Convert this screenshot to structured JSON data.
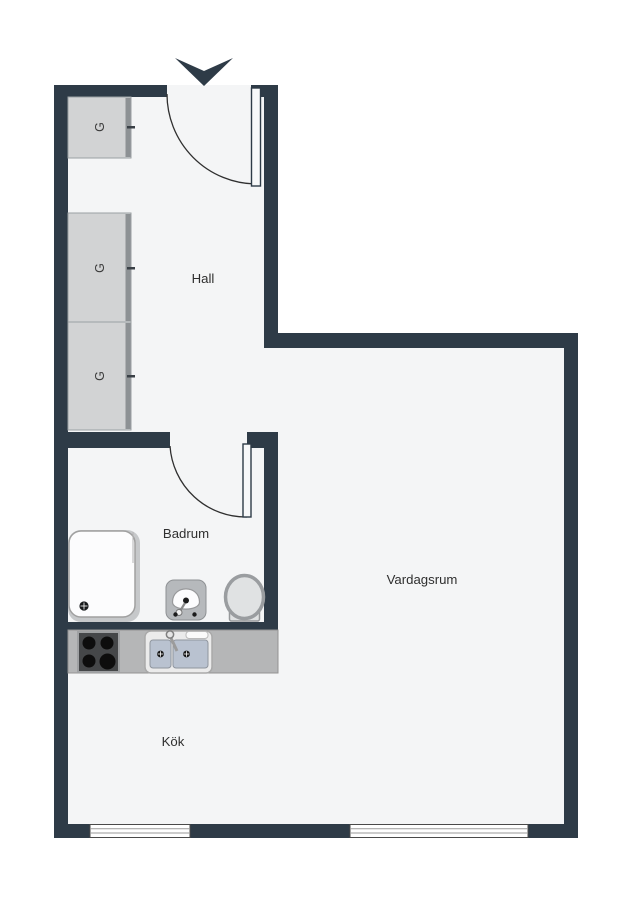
{
  "plan_title": "Studio apartment floor plan",
  "rooms": [
    {
      "id": "hall",
      "label": "Hall"
    },
    {
      "id": "badrum",
      "label": "Badrum"
    },
    {
      "id": "vardagsrum",
      "label": "Vardagsrum"
    },
    {
      "id": "kok",
      "label": "Kök"
    }
  ],
  "wardrobes": [
    {
      "label": "G"
    },
    {
      "label": "G"
    },
    {
      "label": "G"
    }
  ],
  "colors": {
    "wall": "#2e3b47",
    "floor": "#f4f5f6",
    "background": "#ffffff",
    "wardrobe_fill": "#d2d3d4",
    "wardrobe_door_strip": "#8d9194",
    "counter": "#b5b6b7",
    "stove_top": "#454749",
    "burner": "#0d0d0d",
    "sink_basin_blue": "#b9c2d0",
    "fixture_gray": "#b6b9bc",
    "toilet_fill": "#e0e2e3",
    "shower_tray_edge": "#c6c8ca",
    "fixture_white": "#fcfcfd",
    "door_leaf_fill": "#f7f8f9"
  }
}
